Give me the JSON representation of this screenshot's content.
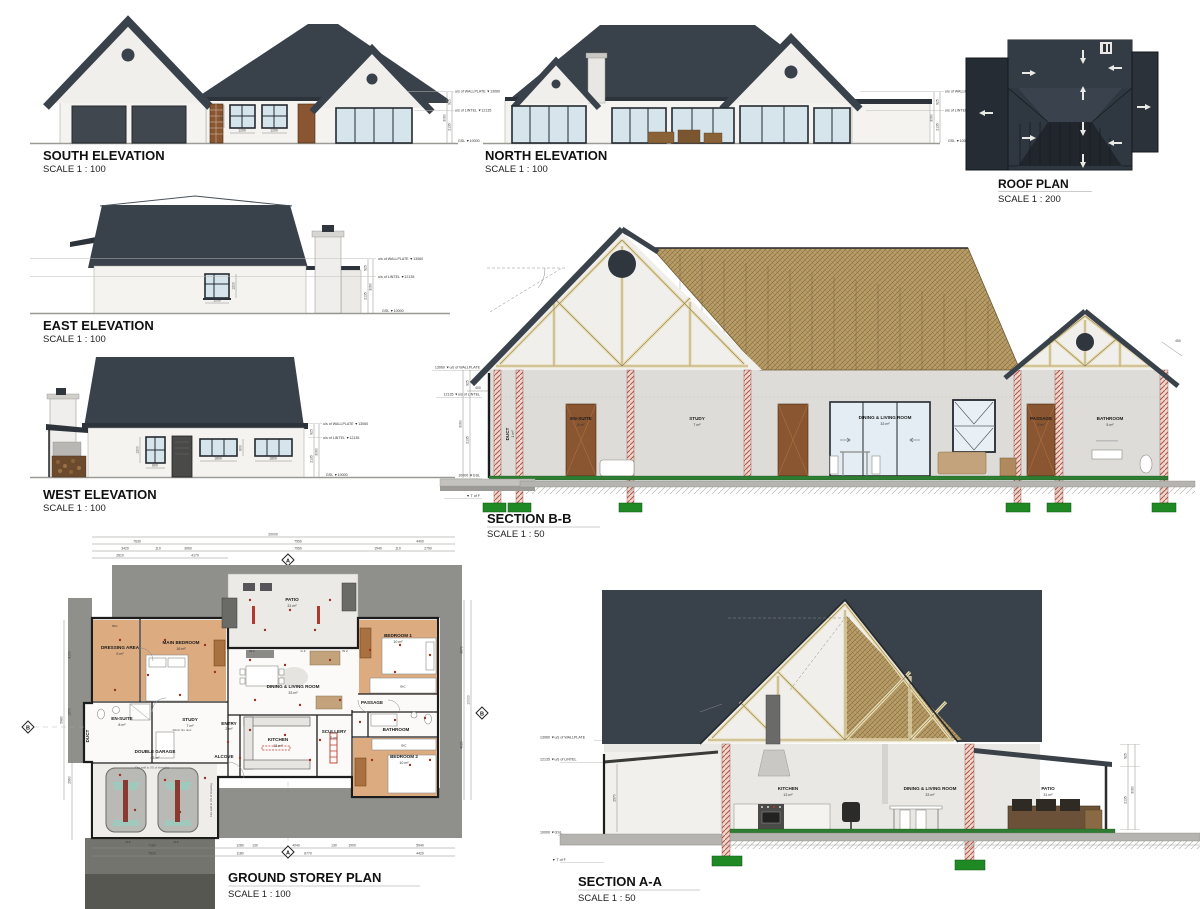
{
  "south": {
    "title": "SOUTH ELEVATION",
    "scale": "SCALE 1 : 100",
    "wallplate": "u/s of WALLPLATE ▼13060",
    "lintel": "u/s of LINTEL ▼12135",
    "gsl": "GSL ▼10000",
    "dim_v": [
      "925",
      "2135",
      "3060"
    ],
    "dim_w": [
      "1200",
      "1200",
      "1200"
    ]
  },
  "north": {
    "title": "NORTH ELEVATION",
    "scale": "SCALE 1 : 100",
    "wallplate": "u/s of WALLPLATE ▼13060",
    "lintel": "u/s of LINTEL ▼12135",
    "gsl": "GSL ▼10000",
    "dim_v": [
      "925",
      "2135",
      "3060"
    ]
  },
  "roof": {
    "title": "ROOF PLAN",
    "scale": "SCALE 1 : 200"
  },
  "east": {
    "title": "EAST ELEVATION",
    "scale": "SCALE 1 : 100",
    "wallplate": "u/s of WALLPLATE ▼13060",
    "lintel": "u/s of LINTEL ▼12135",
    "gsl": "GSL ▼10000",
    "dim_v": [
      "925",
      "2135",
      "3060"
    ],
    "dim_w": [
      "1200",
      "1200"
    ]
  },
  "west": {
    "title": "WEST ELEVATION",
    "scale": "SCALE 1 : 100",
    "wallplate": "u/s of WALLPLATE ▼13060",
    "lintel": "u/s of LINTEL ▼12135",
    "gsl": "GSL ▼10000",
    "dim_v": [
      "925",
      "2135",
      "3060"
    ],
    "dim_w": [
      "1200",
      "600",
      "1800",
      "600",
      "1800"
    ]
  },
  "sbb": {
    "title": "SECTION B-B",
    "scale": "SCALE 1 : 50",
    "lv": [
      "13060 ▼u/s of WALLPLATE",
      "12135 ▼u/s of LINTEL",
      "10000 ▼GSL",
      "▼ T of F"
    ],
    "dim_v": [
      "925",
      "2135",
      "3060"
    ],
    "dim_o": [
      "400",
      "450"
    ],
    "rooms": [
      {
        "n": "DUCT",
        "a": "1 m²"
      },
      {
        "n": "EN-SUITE",
        "a": "8 m²"
      },
      {
        "n": "STUDY",
        "a": "7 m²"
      },
      {
        "n": "DINING & LIVING ROOM",
        "a": "33 m²"
      },
      {
        "n": "PASSAGE",
        "a": "5 m²"
      },
      {
        "n": "BATHROOM",
        "a": "5 m²"
      }
    ]
  },
  "plan": {
    "title": "GROUND STOREY PLAN",
    "scale": "SCALE 1 : 100",
    "rooms": [
      {
        "n": "DRESSING AREA",
        "a": "9 m²"
      },
      {
        "n": "MAIN BEDROOM",
        "a": "16 m²"
      },
      {
        "n": "BEDROOM 1",
        "a": "10 m²"
      },
      {
        "n": "PATIO",
        "a": "31 m²"
      },
      {
        "n": "EN-SUITE",
        "a": "8 m²"
      },
      {
        "n": "DUCT",
        "a": "1 m²"
      },
      {
        "n": "STUDY",
        "a": "7 m²"
      },
      {
        "n": "DINING & LIVING ROOM",
        "a": "33 m²"
      },
      {
        "n": "ENTRY",
        "a": "2 m²"
      },
      {
        "n": "ALCOVE",
        "a": ""
      },
      {
        "n": "KITCHEN",
        "a": "13 m²"
      },
      {
        "n": "SCULLERY",
        "a": "5 m²"
      },
      {
        "n": "PASSAGE",
        "a": "5 m²"
      },
      {
        "n": "BATHROOM",
        "a": "5 m²"
      },
      {
        "n": "BEDROOM 2",
        "a": "10 m²"
      },
      {
        "n": "DOUBLE GARAGE",
        "a": "43 m²"
      }
    ],
    "bic": "BIC",
    "notes": {
      "fire_wall": "Fire wall to US of sheeting",
      "fire_door": "30min fire door"
    },
    "tags": [
      "W 2",
      "G 4",
      "W 2",
      "D 3",
      "D 3"
    ],
    "markers": {
      "a": "A",
      "b": "B"
    },
    "dt": [
      "20000",
      "7630",
      "7950",
      "4400",
      "3420",
      "110",
      "3060",
      "7950",
      "1940",
      "110",
      "2790",
      "2810",
      "4170"
    ],
    "db": [
      "7180",
      "1280",
      "130",
      "4040",
      "130",
      "1900",
      "5940",
      "7830",
      "1180",
      "6770",
      "4420"
    ],
    "dl": [
      "4170",
      "1570",
      "2960",
      "5980"
    ],
    "dr": [
      "3670",
      "4020",
      "10000"
    ]
  },
  "saa": {
    "title": "SECTION A-A",
    "scale": "SCALE 1 : 50",
    "lv": [
      "13060 ▼u/s of WALLPLATE",
      "12135 ▼u/s of LINTEL",
      "10000 ▼GSL",
      "▼ T of F"
    ],
    "dim_v": [
      "925",
      "2135",
      "3060"
    ],
    "dim_o": [
      "400",
      "450",
      "2570"
    ],
    "rooms": [
      {
        "n": "KITCHEN",
        "a": "13 m²"
      },
      {
        "n": "DINING & LIVING ROOM",
        "a": "33 m²"
      },
      {
        "n": "PATIO",
        "a": "31 m²"
      }
    ]
  }
}
